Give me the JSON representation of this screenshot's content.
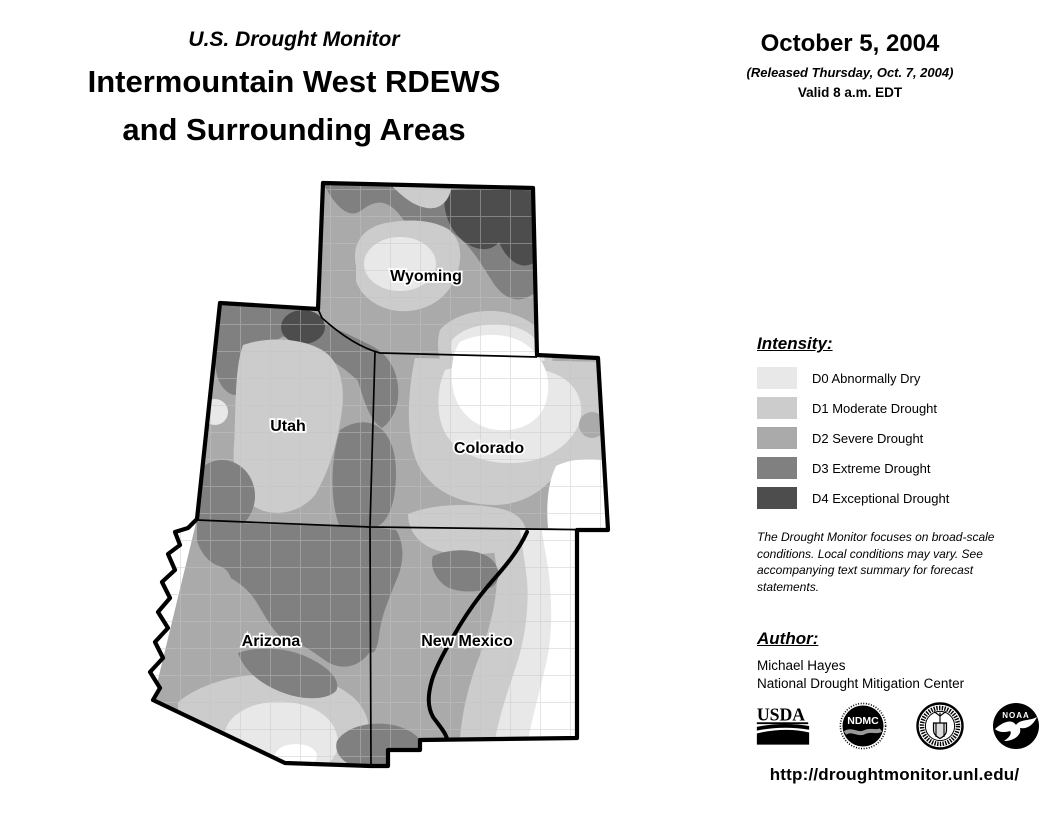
{
  "header": {
    "kicker": "U.S. Drought Monitor",
    "title_line1": "Intermountain West RDEWS",
    "title_line2": "and Surrounding Areas",
    "date": "October 5, 2004",
    "released": "(Released Thursday, Oct. 7, 2004)",
    "valid": "Valid 8 a.m. EDT"
  },
  "map": {
    "state_labels": [
      "Wyoming",
      "Utah",
      "Colorado",
      "Arizona",
      "New Mexico"
    ]
  },
  "legend": {
    "title": "Intensity:",
    "items": [
      {
        "code": "D0",
        "label": "D0 Abnormally Dry",
        "color": "#e8e8e8"
      },
      {
        "code": "D1",
        "label": "D1 Moderate Drought",
        "color": "#cccccc"
      },
      {
        "code": "D2",
        "label": "D2 Severe Drought",
        "color": "#aaaaaa"
      },
      {
        "code": "D3",
        "label": "D3 Extreme Drought",
        "color": "#808080"
      },
      {
        "code": "D4",
        "label": "D4 Exceptional Drought",
        "color": "#4d4d4d"
      }
    ]
  },
  "notes": {
    "disclaimer": "The Drought Monitor focuses on broad-scale conditions. Local conditions may vary. See accompanying text summary for forecast statements."
  },
  "author": {
    "heading": "Author:",
    "name": "Michael Hayes",
    "organization": "National Drought Mitigation Center"
  },
  "logos": [
    {
      "name": "usda-logo",
      "text": "USDA"
    },
    {
      "name": "ndmc-logo",
      "text": "NDMC"
    },
    {
      "name": "commerce-seal-logo",
      "text": ""
    },
    {
      "name": "noaa-logo",
      "text": "NOAA"
    }
  ],
  "footer": {
    "url": "http://droughtmonitor.unl.edu/"
  }
}
